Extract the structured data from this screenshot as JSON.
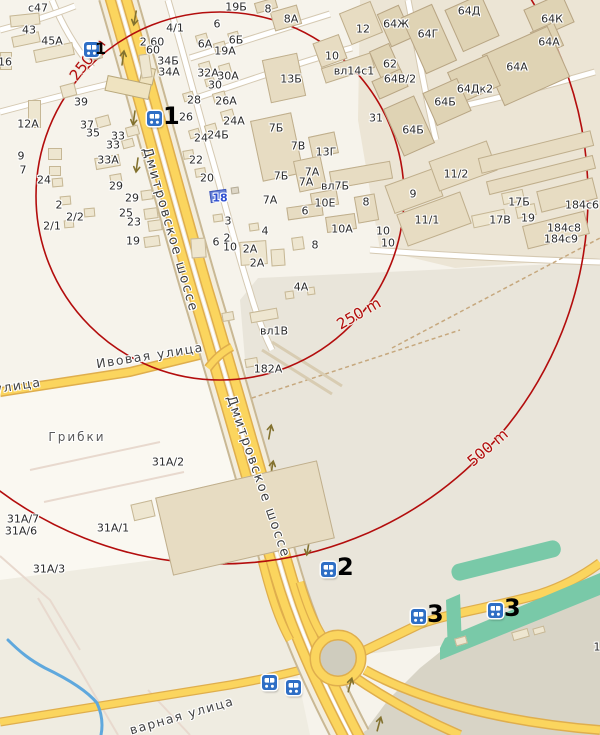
{
  "colors": {
    "radius_red": "#b30d0d",
    "road_yellow": "#fbd55e",
    "road_casing": "#dfae4d",
    "water_blue": "#5fa8dd",
    "green_teal": "#79c9a8",
    "marker_blue": "#2e6ec5",
    "bg_light": "#f6f3eb",
    "bg_industrial": "#e9e5da",
    "bg_dark": "#d8d4c6",
    "building_fill": "#eee6d0",
    "building_tan": "#dfd3b4",
    "selected_blue": "#6a84d8"
  },
  "radius_circles": [
    {
      "label": "250 m",
      "radius_px": 184
    },
    {
      "label": "500 m",
      "radius_px": 368
    }
  ],
  "labels": [
    {
      "t": "с47",
      "x": 38,
      "y": 8
    },
    {
      "t": "43",
      "x": 29,
      "y": 30
    },
    {
      "t": "45А",
      "x": 52,
      "y": 41
    },
    {
      "t": "16",
      "x": 5,
      "y": 62
    },
    {
      "t": "39",
      "x": 81,
      "y": 102
    },
    {
      "t": "37",
      "x": 87,
      "y": 125
    },
    {
      "t": "35",
      "x": 93,
      "y": 133
    },
    {
      "t": "33",
      "x": 118,
      "y": 136
    },
    {
      "t": "33",
      "x": 113,
      "y": 145
    },
    {
      "t": "33А",
      "x": 108,
      "y": 160
    },
    {
      "t": "12А",
      "x": 28,
      "y": 124
    },
    {
      "t": "9",
      "x": 21,
      "y": 156
    },
    {
      "t": "7",
      "x": 23,
      "y": 170
    },
    {
      "t": "24",
      "x": 44,
      "y": 180
    },
    {
      "t": "2",
      "x": 59,
      "y": 205
    },
    {
      "t": "2/2",
      "x": 75,
      "y": 217
    },
    {
      "t": "2/1",
      "x": 52,
      "y": 226
    },
    {
      "t": "29",
      "x": 116,
      "y": 186
    },
    {
      "t": "29",
      "x": 132,
      "y": 198
    },
    {
      "t": "25",
      "x": 126,
      "y": 213
    },
    {
      "t": "23",
      "x": 134,
      "y": 222
    },
    {
      "t": "19",
      "x": 133,
      "y": 241
    },
    {
      "t": "2 60",
      "x": 152,
      "y": 42
    },
    {
      "t": "60",
      "x": 153,
      "y": 50
    },
    {
      "t": "4/1",
      "x": 175,
      "y": 28
    },
    {
      "t": "34Б",
      "x": 168,
      "y": 61
    },
    {
      "t": "34А",
      "x": 169,
      "y": 72
    },
    {
      "t": "6",
      "x": 217,
      "y": 24
    },
    {
      "t": "19Б",
      "x": 236,
      "y": 7
    },
    {
      "t": "8",
      "x": 268,
      "y": 9
    },
    {
      "t": "8А",
      "x": 291,
      "y": 19
    },
    {
      "t": "12",
      "x": 363,
      "y": 29
    },
    {
      "t": "10",
      "x": 332,
      "y": 56
    },
    {
      "t": "вл14с1",
      "x": 354,
      "y": 71
    },
    {
      "t": "13Б",
      "x": 291,
      "y": 79
    },
    {
      "t": "6А",
      "x": 205,
      "y": 44
    },
    {
      "t": "6Б",
      "x": 236,
      "y": 40
    },
    {
      "t": "19А",
      "x": 225,
      "y": 51
    },
    {
      "t": "32А",
      "x": 208,
      "y": 73
    },
    {
      "t": "30А",
      "x": 228,
      "y": 76
    },
    {
      "t": "30",
      "x": 215,
      "y": 85
    },
    {
      "t": "28",
      "x": 194,
      "y": 100
    },
    {
      "t": "26А",
      "x": 226,
      "y": 101
    },
    {
      "t": "26",
      "x": 186,
      "y": 117
    },
    {
      "t": "24А",
      "x": 234,
      "y": 121
    },
    {
      "t": "24Б",
      "x": 218,
      "y": 135
    },
    {
      "t": "24",
      "x": 201,
      "y": 138
    },
    {
      "t": "22",
      "x": 196,
      "y": 160
    },
    {
      "t": "20",
      "x": 207,
      "y": 178
    },
    {
      "t": "18",
      "x": 220,
      "y": 198,
      "c": "blue"
    },
    {
      "t": "7Б",
      "x": 276,
      "y": 128
    },
    {
      "t": "7В",
      "x": 298,
      "y": 146
    },
    {
      "t": "13Г",
      "x": 326,
      "y": 152
    },
    {
      "t": "7Б",
      "x": 281,
      "y": 176
    },
    {
      "t": "7А",
      "x": 312,
      "y": 172
    },
    {
      "t": "7А",
      "x": 306,
      "y": 182
    },
    {
      "t": "вл7Б",
      "x": 335,
      "y": 186
    },
    {
      "t": "7А",
      "x": 270,
      "y": 200
    },
    {
      "t": "10Е",
      "x": 325,
      "y": 203
    },
    {
      "t": "8",
      "x": 366,
      "y": 202
    },
    {
      "t": "6",
      "x": 305,
      "y": 211
    },
    {
      "t": "3",
      "x": 228,
      "y": 221
    },
    {
      "t": "4",
      "x": 265,
      "y": 231
    },
    {
      "t": "10А",
      "x": 342,
      "y": 229
    },
    {
      "t": "31",
      "x": 376,
      "y": 118
    },
    {
      "t": "6",
      "x": 216,
      "y": 242
    },
    {
      "t": "2",
      "x": 227,
      "y": 238
    },
    {
      "t": "10",
      "x": 230,
      "y": 247
    },
    {
      "t": "2А",
      "x": 250,
      "y": 249
    },
    {
      "t": "2А",
      "x": 257,
      "y": 263
    },
    {
      "t": "8",
      "x": 315,
      "y": 245
    },
    {
      "t": "4А",
      "x": 301,
      "y": 287
    },
    {
      "t": "вл1В",
      "x": 274,
      "y": 331
    },
    {
      "t": "182А",
      "x": 268,
      "y": 369
    },
    {
      "t": "10",
      "x": 383,
      "y": 231
    },
    {
      "t": "10",
      "x": 388,
      "y": 243
    },
    {
      "t": "9",
      "x": 413,
      "y": 194
    },
    {
      "t": "11/2",
      "x": 456,
      "y": 174
    },
    {
      "t": "11/1",
      "x": 427,
      "y": 220
    },
    {
      "t": "64Ж",
      "x": 396,
      "y": 24
    },
    {
      "t": "64Г",
      "x": 428,
      "y": 34
    },
    {
      "t": "64Д",
      "x": 469,
      "y": 11
    },
    {
      "t": "64К",
      "x": 552,
      "y": 19
    },
    {
      "t": "64А",
      "x": 549,
      "y": 42
    },
    {
      "t": "64А",
      "x": 517,
      "y": 67
    },
    {
      "t": "62",
      "x": 390,
      "y": 64
    },
    {
      "t": "64В/2",
      "x": 400,
      "y": 79
    },
    {
      "t": "64Дк2",
      "x": 475,
      "y": 89
    },
    {
      "t": "64Б",
      "x": 445,
      "y": 102
    },
    {
      "t": "64Б",
      "x": 413,
      "y": 130
    },
    {
      "t": "17Б",
      "x": 519,
      "y": 202
    },
    {
      "t": "19",
      "x": 528,
      "y": 218
    },
    {
      "t": "17В",
      "x": 500,
      "y": 220
    },
    {
      "t": "184с6",
      "x": 582,
      "y": 205
    },
    {
      "t": "184с8",
      "x": 564,
      "y": 228
    },
    {
      "t": "184с9",
      "x": 561,
      "y": 239
    },
    {
      "t": "31А/2",
      "x": 168,
      "y": 462
    },
    {
      "t": "31А/7",
      "x": 23,
      "y": 519
    },
    {
      "t": "31А/6",
      "x": 21,
      "y": 531
    },
    {
      "t": "31А/1",
      "x": 113,
      "y": 528
    },
    {
      "t": "31А/3",
      "x": 49,
      "y": 569
    },
    {
      "t": "1",
      "x": 597,
      "y": 647
    },
    {
      "t": "Грибки",
      "x": 77,
      "y": 437,
      "c": "locality"
    },
    {
      "t": "Ивовая улица",
      "x": 150,
      "y": 356,
      "c": "street",
      "r": -9
    },
    {
      "t": "улица",
      "x": 18,
      "y": 386,
      "c": "street",
      "r": -9
    },
    {
      "t": "варная улица",
      "x": 182,
      "y": 716,
      "c": "street",
      "r": -16
    },
    {
      "t": "Дмитровское шоссе",
      "x": 170,
      "y": 230,
      "c": "hwy",
      "r": 74
    },
    {
      "t": "Дмитровское шоссе",
      "x": 258,
      "y": 477,
      "c": "hwy",
      "r": 71
    },
    {
      "t": "250 m",
      "x": 88,
      "y": 60,
      "c": "radius",
      "r": -52
    },
    {
      "t": "250 m",
      "x": 359,
      "y": 314,
      "c": "radius",
      "r": -30
    },
    {
      "t": "500 m",
      "x": 488,
      "y": 448,
      "c": "radius",
      "r": -41
    }
  ],
  "buildings": [
    {
      "x": 10,
      "y": 14,
      "w": 30,
      "h": 12,
      "r": -6,
      "c": "a"
    },
    {
      "x": 12,
      "y": 34,
      "w": 28,
      "h": 11,
      "r": -12,
      "c": "a"
    },
    {
      "x": 34,
      "y": 46,
      "w": 40,
      "h": 13,
      "r": -12,
      "c": "a"
    },
    {
      "x": 0,
      "y": 52,
      "w": 12,
      "h": 18,
      "r": 0,
      "c": "a"
    },
    {
      "x": 88,
      "y": 50,
      "w": 14,
      "h": 10,
      "r": -15,
      "c": "a"
    },
    {
      "x": 28,
      "y": 100,
      "w": 13,
      "h": 28,
      "r": 0,
      "c": "a"
    },
    {
      "x": 48,
      "y": 148,
      "w": 14,
      "h": 12,
      "r": 0,
      "c": "a"
    },
    {
      "x": 49,
      "y": 166,
      "w": 12,
      "h": 10,
      "r": 0,
      "c": "a"
    },
    {
      "x": 52,
      "y": 178,
      "w": 11,
      "h": 9,
      "r": -5,
      "c": "a"
    },
    {
      "x": 60,
      "y": 196,
      "w": 11,
      "h": 9,
      "r": -5,
      "c": "a"
    },
    {
      "x": 84,
      "y": 208,
      "w": 11,
      "h": 9,
      "r": -5,
      "c": "a"
    },
    {
      "x": 64,
      "y": 220,
      "w": 10,
      "h": 8,
      "r": -5,
      "c": "a"
    },
    {
      "x": 61,
      "y": 84,
      "w": 15,
      "h": 13,
      "r": -15,
      "c": "a"
    },
    {
      "x": 96,
      "y": 116,
      "w": 14,
      "h": 11,
      "r": -15,
      "c": "a"
    },
    {
      "x": 126,
      "y": 126,
      "w": 13,
      "h": 10,
      "r": -15,
      "c": "a"
    },
    {
      "x": 122,
      "y": 139,
      "w": 12,
      "h": 9,
      "r": -15,
      "c": "a"
    },
    {
      "x": 95,
      "y": 156,
      "w": 25,
      "h": 12,
      "r": -10,
      "c": "a"
    },
    {
      "x": 110,
      "y": 174,
      "w": 12,
      "h": 10,
      "r": -10,
      "c": "a"
    },
    {
      "x": 141,
      "y": 190,
      "w": 12,
      "h": 10,
      "r": -8,
      "c": "a"
    },
    {
      "x": 144,
      "y": 208,
      "w": 14,
      "h": 11,
      "r": -8,
      "c": "a"
    },
    {
      "x": 148,
      "y": 220,
      "w": 14,
      "h": 11,
      "r": -8,
      "c": "a"
    },
    {
      "x": 144,
      "y": 236,
      "w": 16,
      "h": 11,
      "r": -8,
      "c": "a"
    },
    {
      "x": 140,
      "y": 54,
      "w": 11,
      "h": 24,
      "r": -8,
      "c": "a"
    },
    {
      "x": 196,
      "y": 34,
      "w": 12,
      "h": 10,
      "r": -16,
      "c": "a"
    },
    {
      "x": 214,
      "y": 42,
      "w": 12,
      "h": 10,
      "r": -16,
      "c": "a"
    },
    {
      "x": 228,
      "y": 32,
      "w": 11,
      "h": 8,
      "r": -16,
      "c": "a"
    },
    {
      "x": 199,
      "y": 62,
      "w": 12,
      "h": 10,
      "r": -16,
      "c": "a"
    },
    {
      "x": 219,
      "y": 64,
      "w": 12,
      "h": 10,
      "r": -16,
      "c": "a"
    },
    {
      "x": 205,
      "y": 78,
      "w": 10,
      "h": 8,
      "r": -16,
      "c": "a"
    },
    {
      "x": 183,
      "y": 92,
      "w": 11,
      "h": 9,
      "r": -16,
      "c": "a"
    },
    {
      "x": 213,
      "y": 92,
      "w": 13,
      "h": 10,
      "r": -16,
      "c": "a"
    },
    {
      "x": 221,
      "y": 110,
      "w": 13,
      "h": 10,
      "r": -16,
      "c": "a"
    },
    {
      "x": 205,
      "y": 124,
      "w": 12,
      "h": 10,
      "r": -16,
      "c": "a"
    },
    {
      "x": 189,
      "y": 129,
      "w": 11,
      "h": 9,
      "r": -16,
      "c": "a"
    },
    {
      "x": 183,
      "y": 150,
      "w": 11,
      "h": 9,
      "r": -10,
      "c": "a"
    },
    {
      "x": 195,
      "y": 168,
      "w": 11,
      "h": 9,
      "r": -10,
      "c": "a"
    },
    {
      "x": 210,
      "y": 190,
      "w": 17,
      "h": 12,
      "r": -8,
      "c": "sel"
    },
    {
      "x": 231,
      "y": 187,
      "w": 8,
      "h": 7,
      "r": -8,
      "c": "grey"
    },
    {
      "x": 213,
      "y": 214,
      "w": 10,
      "h": 8,
      "r": -8,
      "c": "a"
    },
    {
      "x": 249,
      "y": 223,
      "w": 10,
      "h": 8,
      "r": -8,
      "c": "a"
    },
    {
      "x": 191,
      "y": 238,
      "w": 15,
      "h": 20,
      "r": -4,
      "c": "a"
    },
    {
      "x": 240,
      "y": 241,
      "w": 27,
      "h": 24,
      "r": -4,
      "c": "a"
    },
    {
      "x": 271,
      "y": 249,
      "w": 14,
      "h": 17,
      "r": -4,
      "c": "a"
    },
    {
      "x": 292,
      "y": 237,
      "w": 12,
      "h": 13,
      "r": -8,
      "c": "a"
    },
    {
      "x": 307,
      "y": 287,
      "w": 8,
      "h": 8,
      "r": -8,
      "c": "a"
    },
    {
      "x": 285,
      "y": 291,
      "w": 9,
      "h": 8,
      "r": -8,
      "c": "a"
    },
    {
      "x": 250,
      "y": 310,
      "w": 28,
      "h": 11,
      "r": -10,
      "c": "a"
    },
    {
      "x": 222,
      "y": 312,
      "w": 12,
      "h": 9,
      "r": -10,
      "c": "a"
    },
    {
      "x": 245,
      "y": 358,
      "w": 13,
      "h": 9,
      "r": -10,
      "c": "a"
    },
    {
      "x": 266,
      "y": 56,
      "w": 36,
      "h": 44,
      "r": -12,
      "c": "b"
    },
    {
      "x": 272,
      "y": 8,
      "w": 28,
      "h": 20,
      "r": -16,
      "c": "b"
    },
    {
      "x": 255,
      "y": 0,
      "w": 22,
      "h": 11,
      "r": -16,
      "c": "b"
    },
    {
      "x": 344,
      "y": 6,
      "w": 34,
      "h": 34,
      "r": -22,
      "c": "b"
    },
    {
      "x": 316,
      "y": 38,
      "w": 28,
      "h": 26,
      "r": -20,
      "c": "b"
    },
    {
      "x": 322,
      "y": 60,
      "w": 52,
      "h": 16,
      "r": -18,
      "c": "b"
    },
    {
      "x": 256,
      "y": 116,
      "w": 42,
      "h": 62,
      "r": -12,
      "c": "b"
    },
    {
      "x": 310,
      "y": 134,
      "w": 27,
      "h": 22,
      "r": -12,
      "c": "b"
    },
    {
      "x": 296,
      "y": 158,
      "w": 28,
      "h": 32,
      "r": -12,
      "c": "b"
    },
    {
      "x": 330,
      "y": 166,
      "w": 62,
      "h": 18,
      "r": -10,
      "c": "b"
    },
    {
      "x": 311,
      "y": 191,
      "w": 27,
      "h": 16,
      "r": -10,
      "c": "b"
    },
    {
      "x": 287,
      "y": 205,
      "w": 36,
      "h": 13,
      "r": -8,
      "c": "b"
    },
    {
      "x": 326,
      "y": 215,
      "w": 30,
      "h": 16,
      "r": -8,
      "c": "b"
    },
    {
      "x": 356,
      "y": 195,
      "w": 21,
      "h": 27,
      "r": -10,
      "c": "b"
    },
    {
      "x": 383,
      "y": 8,
      "w": 24,
      "h": 36,
      "r": -24,
      "c": "c"
    },
    {
      "x": 412,
      "y": 8,
      "w": 34,
      "h": 62,
      "r": -24,
      "c": "c"
    },
    {
      "x": 452,
      "y": 0,
      "w": 40,
      "h": 46,
      "r": -24,
      "c": "c"
    },
    {
      "x": 528,
      "y": 0,
      "w": 42,
      "h": 32,
      "r": -24,
      "c": "c"
    },
    {
      "x": 534,
      "y": 26,
      "w": 26,
      "h": 26,
      "r": -24,
      "c": "c"
    },
    {
      "x": 490,
      "y": 38,
      "w": 72,
      "h": 56,
      "r": -24,
      "c": "c"
    },
    {
      "x": 452,
      "y": 62,
      "w": 44,
      "h": 34,
      "r": -24,
      "c": "c"
    },
    {
      "x": 428,
      "y": 84,
      "w": 38,
      "h": 36,
      "r": -24,
      "c": "c"
    },
    {
      "x": 392,
      "y": 100,
      "w": 34,
      "h": 52,
      "r": -24,
      "c": "c"
    },
    {
      "x": 374,
      "y": 46,
      "w": 22,
      "h": 30,
      "r": -24,
      "c": "c"
    },
    {
      "x": 374,
      "y": 74,
      "w": 32,
      "h": 20,
      "r": -24,
      "c": "c"
    },
    {
      "x": 388,
      "y": 176,
      "w": 52,
      "h": 30,
      "r": -20,
      "c": "b"
    },
    {
      "x": 432,
      "y": 150,
      "w": 62,
      "h": 32,
      "r": -20,
      "c": "b"
    },
    {
      "x": 400,
      "y": 202,
      "w": 68,
      "h": 34,
      "r": -20,
      "c": "b"
    },
    {
      "x": 478,
      "y": 144,
      "w": 116,
      "h": 16,
      "r": -14,
      "c": "b"
    },
    {
      "x": 486,
      "y": 168,
      "w": 110,
      "h": 14,
      "r": -14,
      "c": "b"
    },
    {
      "x": 538,
      "y": 184,
      "w": 58,
      "h": 22,
      "r": -14,
      "c": "b"
    },
    {
      "x": 524,
      "y": 218,
      "w": 64,
      "h": 24,
      "r": -14,
      "c": "b"
    },
    {
      "x": 472,
      "y": 212,
      "w": 34,
      "h": 13,
      "r": -12,
      "c": "a"
    },
    {
      "x": 516,
      "y": 205,
      "w": 20,
      "h": 12,
      "r": -12,
      "c": "a"
    },
    {
      "x": 502,
      "y": 191,
      "w": 22,
      "h": 12,
      "r": -12,
      "c": "a"
    },
    {
      "x": 162,
      "y": 478,
      "w": 166,
      "h": 80,
      "r": -13,
      "c": "b"
    },
    {
      "x": 132,
      "y": 502,
      "w": 22,
      "h": 17,
      "r": -13,
      "c": "a"
    },
    {
      "x": 455,
      "y": 637,
      "w": 12,
      "h": 8,
      "r": -16,
      "c": "a"
    },
    {
      "x": 512,
      "y": 630,
      "w": 17,
      "h": 9,
      "r": -16,
      "c": "a"
    },
    {
      "x": 533,
      "y": 627,
      "w": 12,
      "h": 7,
      "r": -16,
      "c": "a"
    }
  ],
  "markers": [
    {
      "num": "1",
      "x": 84,
      "y": 42,
      "cls": "sm"
    },
    {
      "num": "1",
      "x": 147,
      "y": 111
    },
    {
      "num": "2",
      "x": 321,
      "y": 562
    },
    {
      "num": "3",
      "x": 411,
      "y": 609
    },
    {
      "num": "3",
      "x": 488,
      "y": 603
    },
    {
      "num": "",
      "x": 262,
      "y": 675
    },
    {
      "num": "",
      "x": 286,
      "y": 680
    }
  ]
}
